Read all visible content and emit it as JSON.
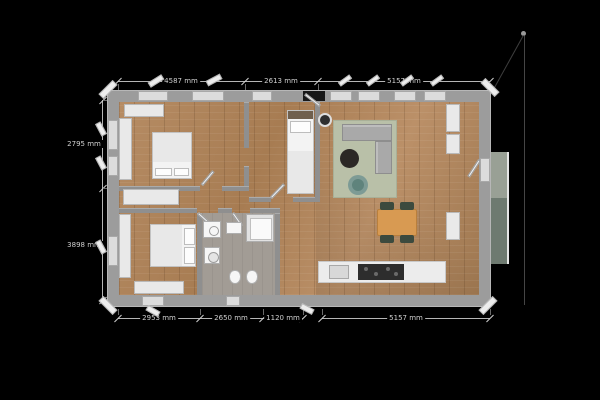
{
  "view": {
    "background": "#000000",
    "unit": "mm"
  },
  "dimensions": {
    "top": [
      {
        "label": "4587 mm"
      },
      {
        "label": "2613 mm"
      },
      {
        "label": "5157 mm"
      }
    ],
    "left": [
      {
        "label": "2795 mm"
      },
      {
        "label": "3898 mm"
      }
    ],
    "bottom": [
      {
        "label": "2953 mm"
      },
      {
        "label": "2650 mm"
      },
      {
        "label": "1120 mm"
      },
      {
        "label": "5157 mm"
      }
    ]
  },
  "colors": {
    "background": "#000000",
    "wall": "#9c9c9c",
    "floor_wood": "#ad8360",
    "floor_bath": "#a29c95",
    "rug": "#b9c0a8",
    "sofa": "#a9a9a9",
    "accent_chair": "#7d9b95",
    "coffee_table": "#2b2825",
    "dining_table": "#d89a52",
    "dining_chair": "#3c4a3e",
    "kitchen_cooktop": "#2d2d2d",
    "balcony_light": "#99a095",
    "balcony_dark": "#6e7a70",
    "dimension_text": "#cfcfcf"
  }
}
